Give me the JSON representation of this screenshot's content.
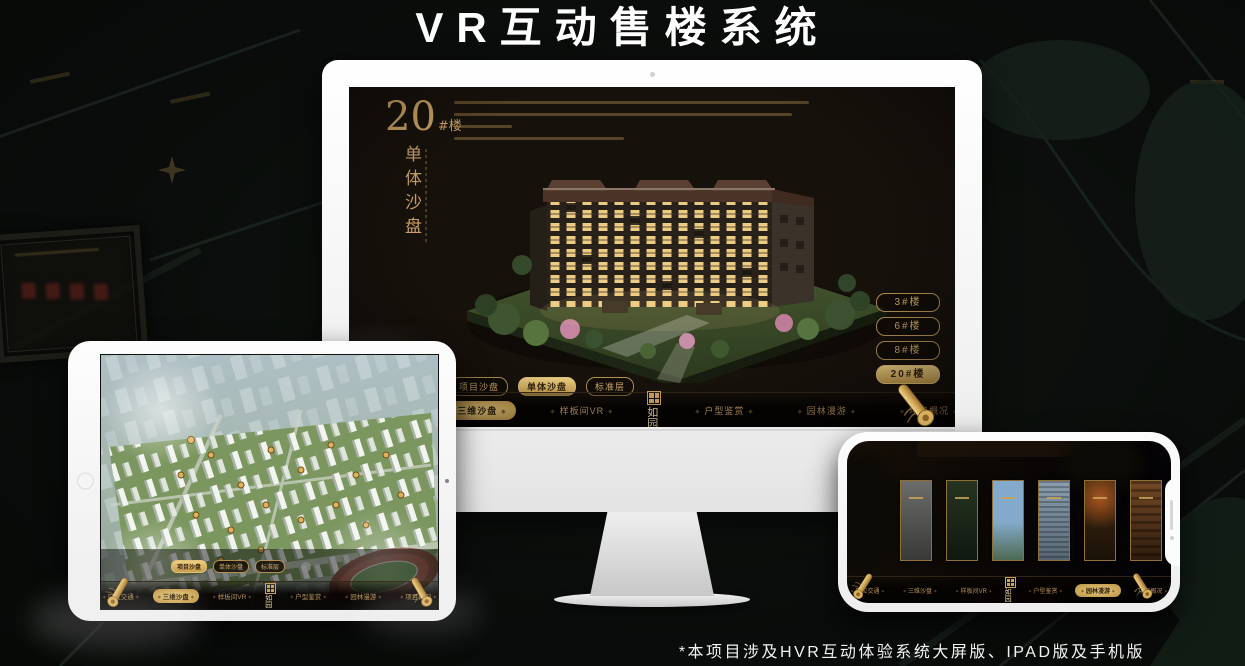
{
  "title": "VR互动售楼系统",
  "footer_note": "*本项目涉及HVR互动体验系统大屏版、IPAD版及手机版",
  "colors": {
    "gold": "#c9a163",
    "gold_active": "#d9b366",
    "screen_bg": "#17110b",
    "page_bg": "#0a0d0b"
  },
  "nav": {
    "logo": "如园",
    "items": [
      "区位交通",
      "三维沙盘",
      "样板间VR",
      "户型鉴赏",
      "园林漫游",
      "项目概况"
    ]
  },
  "tabs": [
    "项目沙盘",
    "单体沙盘",
    "标准层"
  ],
  "monitor": {
    "block_number": "20",
    "block_unit": "#楼",
    "page_subtitle": "单体沙盘",
    "active_tab": "单体沙盘",
    "active_nav": "三维沙盘",
    "floor_buttons": [
      "3#楼",
      "6#楼",
      "8#楼",
      "20#楼"
    ],
    "active_floor": "20#楼"
  },
  "tablet": {
    "active_tab": "项目沙盘",
    "active_nav": "三维沙盘"
  },
  "phone": {
    "active_nav": "园林漫游",
    "panorama_card_count": 6
  }
}
